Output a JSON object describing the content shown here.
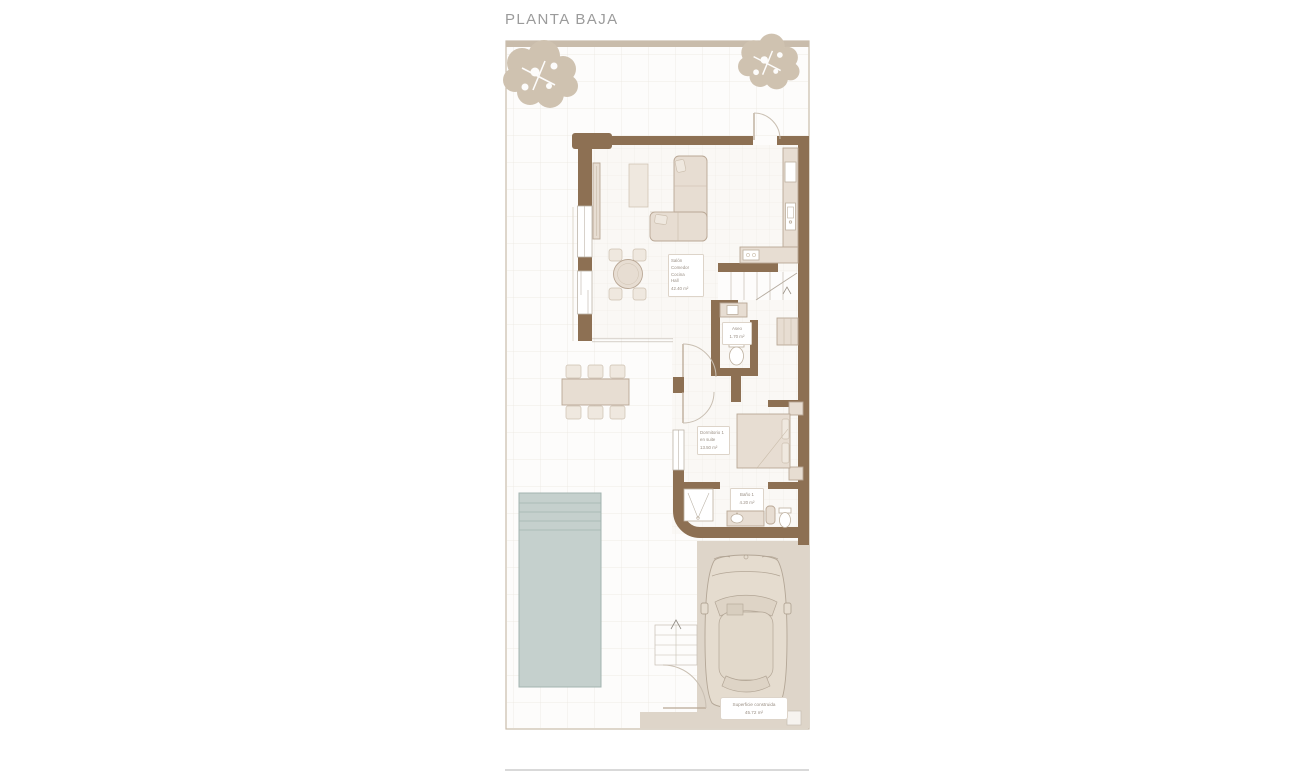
{
  "title": "PLANTA BAJA",
  "rooms": {
    "living": {
      "lines": [
        "Salón",
        "Comedor",
        "Cocina",
        "Hall"
      ],
      "area": "42.40 m²"
    },
    "aseo": {
      "name": "Aseo",
      "area": "1.70 m²"
    },
    "bedroom": {
      "lines": [
        "Dormitorio 1",
        "en suite"
      ],
      "area": "13.50 m²"
    },
    "bath": {
      "name": "Baño 1",
      "area": "4.20 m²"
    },
    "built": {
      "name": "Superficie construida",
      "area": "45.72 m²"
    }
  },
  "colors": {
    "wall": "#8d7053",
    "plot_border": "#c9bcab",
    "tree": "#cfc2b0",
    "floor": "#faf8f5",
    "grid_in": "#eee9e3",
    "grid_out": "#eae6df",
    "furn_fill": "#e7ddd2",
    "furn_stroke": "#b9a795",
    "pool_fill": "#c5d0cd",
    "pool_stroke": "#a3b4b0",
    "drive": "#ded5c9",
    "line_light": "#cfc6bb",
    "arc_line": "#c9bfb2",
    "label_text": "#9a8f84",
    "label_border": "#ddd4c9",
    "title_text": "#9b9b9b",
    "divider": "#d9d9d9",
    "fixture_stroke": "#bdb09f"
  }
}
